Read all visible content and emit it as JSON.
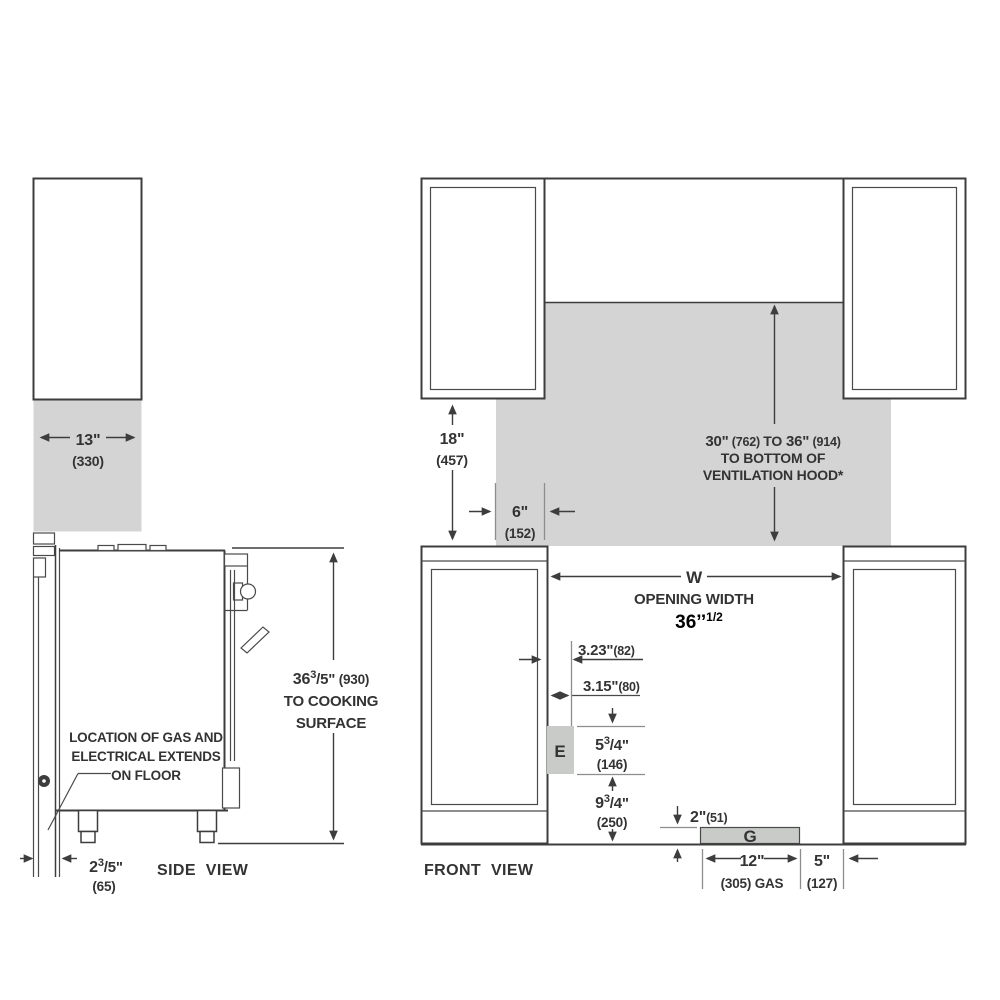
{
  "diagram_title": "range installation clearances",
  "colors": {
    "shade": "#d3d4d3",
    "line": "#3d3d3d",
    "annotation": "#000000"
  },
  "side_view": {
    "label": "SIDE VIEW",
    "dim_depth": {
      "main": "13\"",
      "paren": "(330)"
    },
    "dim_height": {
      "num": "36",
      "sup": "3",
      "den": "/5\"",
      "paren": " (930)",
      "line2": "TO COOKING",
      "line3": "SURFACE"
    },
    "note": {
      "line1": "LOCATION OF GAS AND",
      "line2": "ELECTRICAL EXTENDS",
      "line3": "ON FLOOR"
    },
    "dim_wall_gap": {
      "num": "2",
      "sup": "3",
      "den": "/5\"",
      "paren": "(65)"
    }
  },
  "front_view": {
    "label": "FRONT VIEW",
    "dim_cabinet_height": {
      "main": "18\"",
      "paren": "(457)"
    },
    "dim_side_clearance": {
      "main": "6\"",
      "paren": "(152)"
    },
    "hood_clearance": {
      "part1": "30\"",
      "part2": " (762) ",
      "part3": "TO",
      "part4": " 36\"",
      "part5": " (914)",
      "line2": "TO BOTTOM OF",
      "line3": "VENTILATION HOOD*"
    },
    "opening": {
      "symbol": "W",
      "label": "OPENING WIDTH",
      "value": "36’’",
      "value_sup": "1/2"
    },
    "dim_electrical_offset": {
      "main": "3.23\"",
      "paren": "(82)"
    },
    "dim_electrical_width": {
      "main": "3.15\"",
      "paren": "(80)"
    },
    "electrical_box_label": "E",
    "dim_electrical_height": {
      "num": "5",
      "sup": "3",
      "den": "/4\"",
      "paren": "(146)"
    },
    "dim_electrical_floor": {
      "num": "9",
      "sup": "3",
      "den": "/4\"",
      "paren": "(250)"
    },
    "dim_gas_height": {
      "main": "2\"",
      "paren": "(51)"
    },
    "gas_box_label": "G",
    "dim_gas_width": {
      "main": "12\"",
      "paren": "(305) GAS"
    },
    "dim_gas_offset": {
      "main": "5\"",
      "paren": "(127)"
    }
  }
}
